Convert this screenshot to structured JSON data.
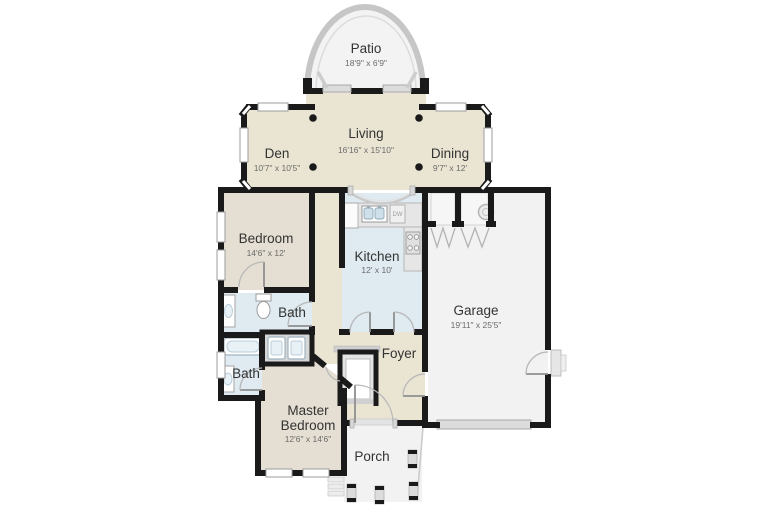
{
  "rooms": {
    "patio": {
      "name": "Patio",
      "dims": "18'9\" x 6'9\""
    },
    "den": {
      "name": "Den",
      "dims": "10'7\" x 10'5\""
    },
    "living": {
      "name": "Living",
      "dims": "16'16\" x 15'10\""
    },
    "dining": {
      "name": "Dining",
      "dims": "9'7\" x 12'"
    },
    "bedroom": {
      "name": "Bedroom",
      "dims": "14'6\" x 12'"
    },
    "kitchen": {
      "name": "Kitchen",
      "dims": "12' x 10'"
    },
    "garage": {
      "name": "Garage",
      "dims": "19'11\" x 25'5\""
    },
    "bath1": {
      "name": "Bath"
    },
    "bath2": {
      "name": "Bath"
    },
    "foyer": {
      "name": "Foyer"
    },
    "master": {
      "name": "Master Bedroom",
      "line1": "Master",
      "line2": "Bedroom",
      "dims": "12'6\" x 14'6\""
    },
    "porch": {
      "name": "Porch"
    }
  },
  "appliance_labels": {
    "dishwasher": "DW"
  },
  "colors": {
    "wall": "#1a1a1a",
    "floor_living_areas": "#eae5d3",
    "floor_bedrooms": "#e5dfd3",
    "floor_kitchen_baths": "#dfeaf1",
    "floor_outdoor_garage": "#f2f2f2",
    "trim_gray": "#c9c9c9",
    "background": "#ffffff"
  }
}
